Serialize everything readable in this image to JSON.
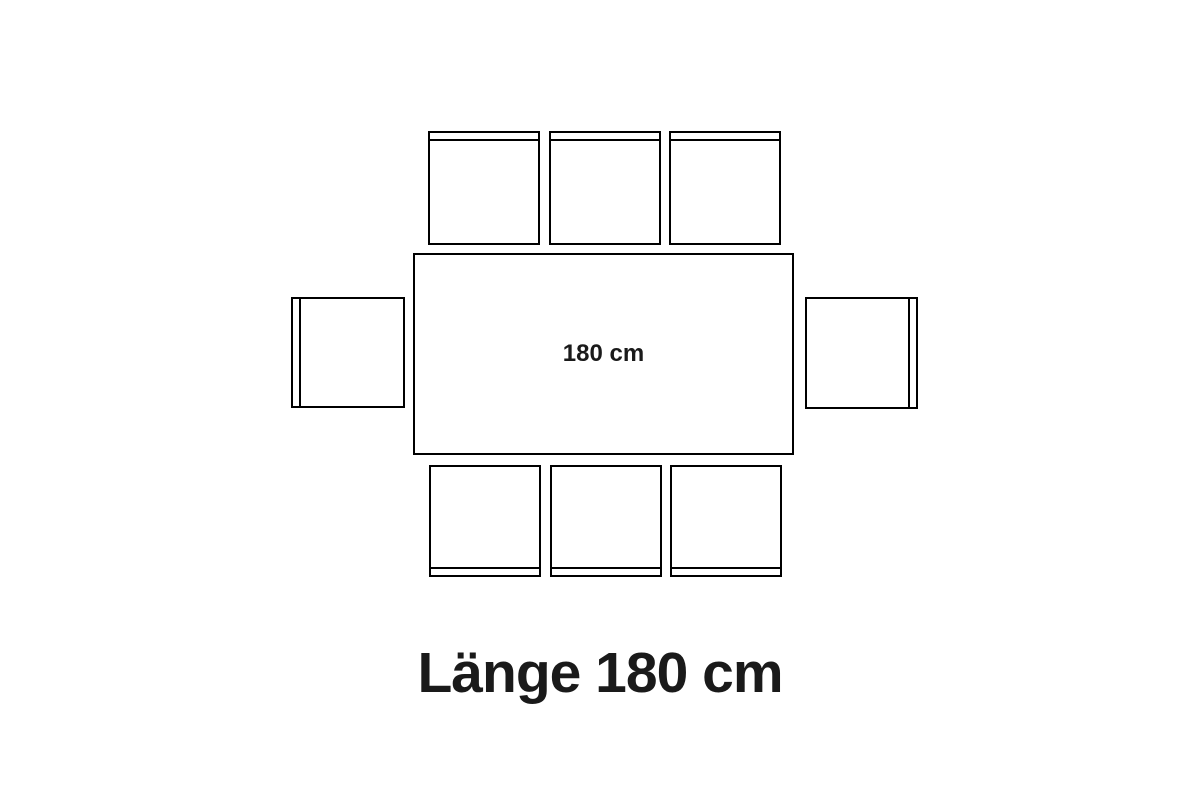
{
  "diagram": {
    "title": "dining-table-seating-plan",
    "table": {
      "label": "180 cm"
    },
    "caption": {
      "text": "Länge 180 cm"
    },
    "seats": {
      "top": 3,
      "bottom": 3,
      "left": 1,
      "right": 1,
      "total": 8
    },
    "colors": {
      "background": "#ffffff",
      "line": "#000000",
      "text": "#1a1a1a"
    }
  }
}
